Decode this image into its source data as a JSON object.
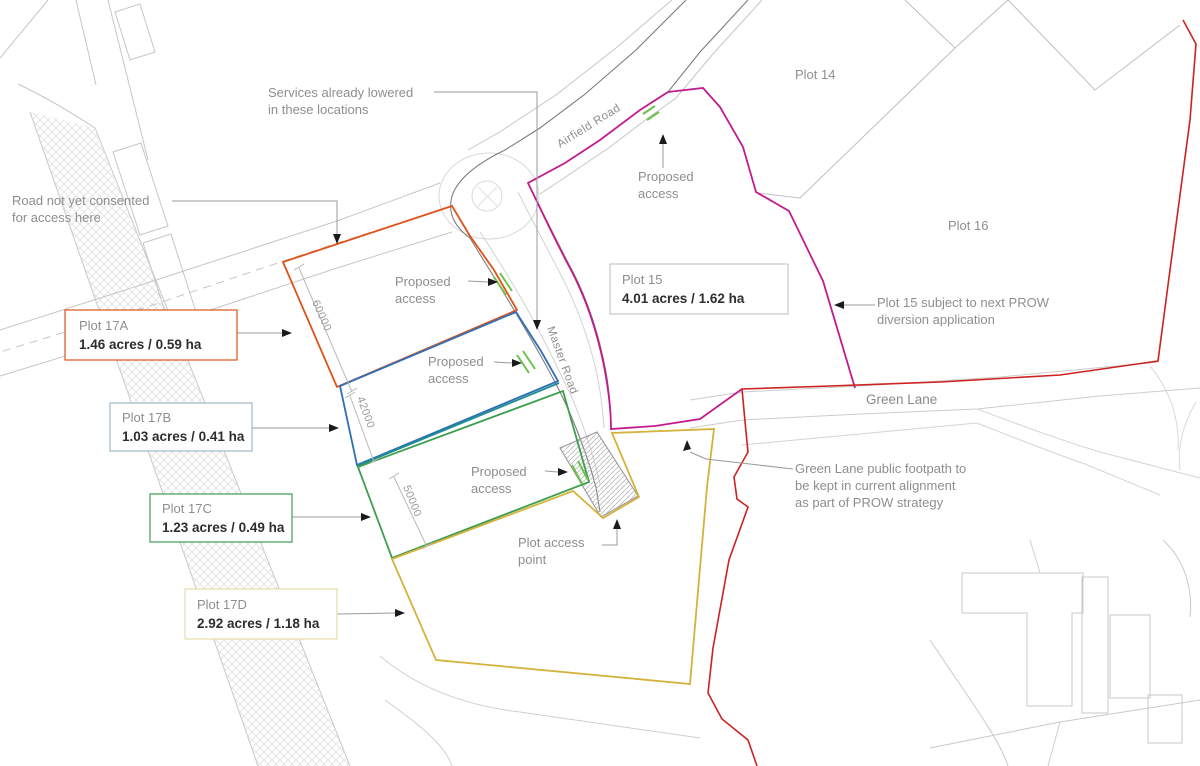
{
  "plots": [
    {
      "id": "17A",
      "name": "Plot 17A",
      "area": "1.46 acres / 0.59 ha",
      "color": "#DD5318",
      "box_border": "#DD5318"
    },
    {
      "id": "17B",
      "name": "Plot 17B",
      "area": "1.03 acres / 0.41 ha",
      "color": "#2E6FB7",
      "box_border": "#9FB8C6"
    },
    {
      "id": "17C",
      "name": "Plot 17C",
      "area": "1.23 acres / 0.49 ha",
      "color": "#3E9E4F",
      "box_border": "#3E9E4F"
    },
    {
      "id": "17D",
      "name": "Plot 17D",
      "area": "2.92 acres / 1.18 ha",
      "color": "#D4B23C",
      "box_border": "#E6DCAC"
    },
    {
      "id": "15",
      "name": "Plot 15",
      "area": "4.01 acres / 1.62 ha",
      "color": "#C11B8E",
      "box_border": "#C9C9C9"
    }
  ],
  "plain_plots": {
    "plot14": "Plot 14",
    "plot16": "Plot 16"
  },
  "roads": {
    "airfield": "Airfield Road",
    "master": "Master Road",
    "green_lane": "Green Lane"
  },
  "annotations": {
    "services": [
      "Services already lowered",
      "in these locations"
    ],
    "consent": [
      "Road not yet consented",
      "for access here"
    ],
    "proposed_access": [
      "Proposed",
      "access"
    ],
    "plot_access": [
      "Plot access",
      "point"
    ],
    "prow": [
      "Plot 15 subject to next PROW",
      "diversion application"
    ],
    "footpath": [
      "Green Lane public footpath to",
      "be kept in current alignment",
      "as part of PROW strategy"
    ]
  },
  "dimensions": [
    "60000",
    "42000",
    "50000"
  ],
  "colors": {
    "boundary_red": "#CE2222",
    "access_green": "#6CC24A",
    "teal_divider": "#1D8F8F",
    "base_line": "#c6c6c6",
    "road_edge": "#7d7d7d"
  }
}
